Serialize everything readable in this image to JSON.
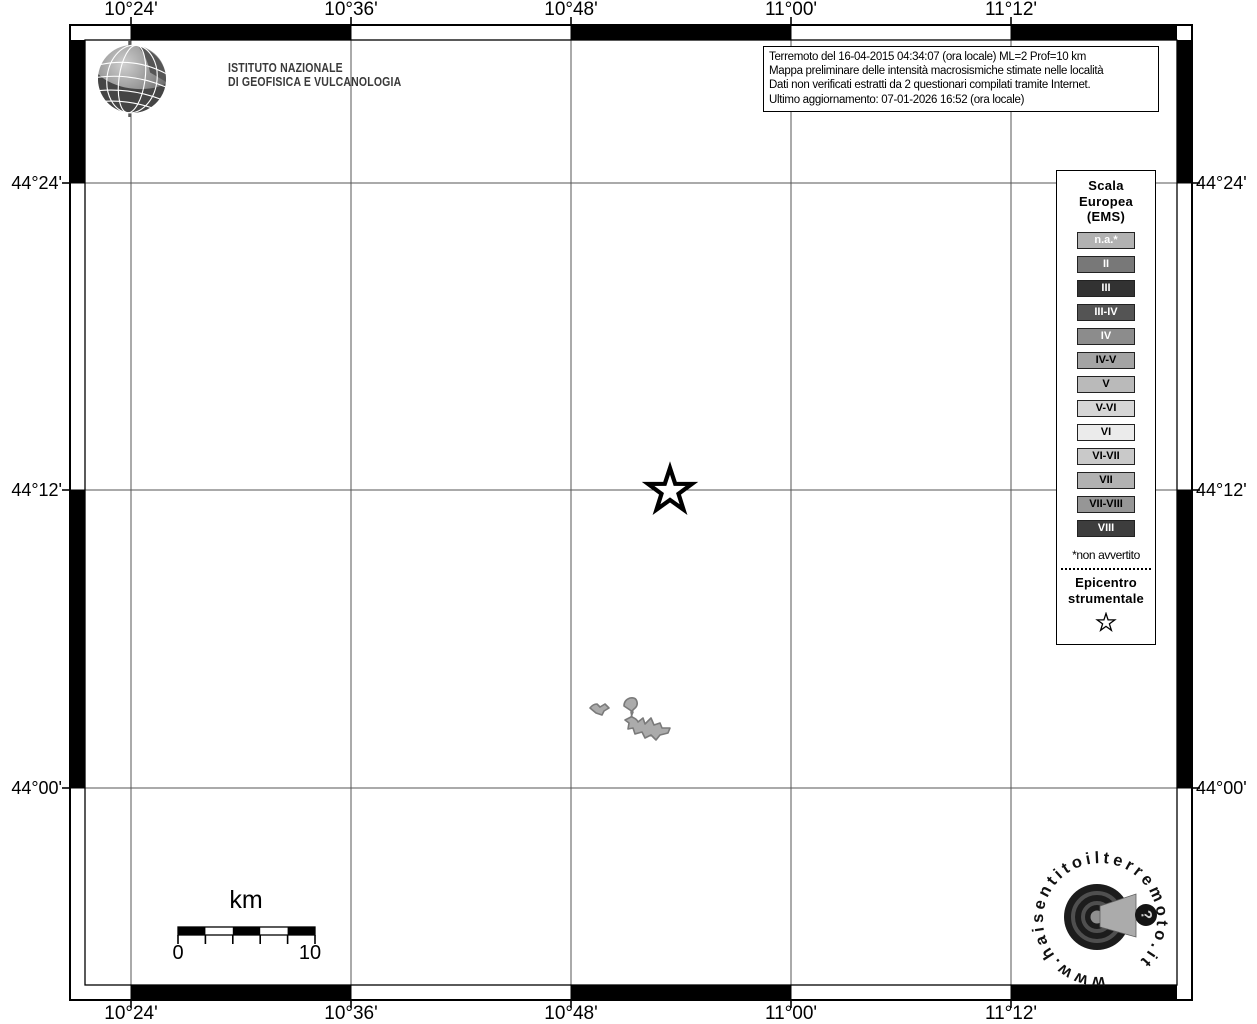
{
  "branding": {
    "institute_name": "ISTITUTO NAZIONALE\nDI GEOFISICA E VULCANOLOGIA"
  },
  "info_box": {
    "line1": "Terremoto del 16-04-2015 04:34:07 (ora locale) ML=2 Prof=10 km",
    "line2": "Mappa preliminare delle intensità macrosismiche stimate nelle località",
    "line3": "Dati non verificati estratti da 2 questionari compilati tramite Internet.",
    "line4": "Ultimo aggiornamento: 07-01-2026 16:52 (ora locale)"
  },
  "axes": {
    "top": [
      "10°24'",
      "10°36'",
      "10°48'",
      "11°00'",
      "11°12'"
    ],
    "bottom": [
      "10°24'",
      "10°36'",
      "10°48'",
      "11°00'",
      "11°12'"
    ],
    "left": [
      "44°24'",
      "44°12'",
      "44°00'"
    ],
    "right": [
      "44°24'",
      "44°12'",
      "44°00'"
    ]
  },
  "legend": {
    "title": "Scala\nEuropea\n(EMS)",
    "items": [
      {
        "label": "n.a.*",
        "bg": "#b2b2b2",
        "fg": "#ffffff"
      },
      {
        "label": "II",
        "bg": "#787878",
        "fg": "#ffffff"
      },
      {
        "label": "III",
        "bg": "#323232",
        "fg": "#ffffff"
      },
      {
        "label": "III-IV",
        "bg": "#545454",
        "fg": "#ffffff"
      },
      {
        "label": "IV",
        "bg": "#8c8c8c",
        "fg": "#ffffff"
      },
      {
        "label": "IV-V",
        "bg": "#a4a4a4",
        "fg": "#000000"
      },
      {
        "label": "V",
        "bg": "#bababa",
        "fg": "#000000"
      },
      {
        "label": "V-VI",
        "bg": "#d6d6d6",
        "fg": "#000000"
      },
      {
        "label": "VI",
        "bg": "#ebebeb",
        "fg": "#000000"
      },
      {
        "label": "VI-VII",
        "bg": "#c9c9c9",
        "fg": "#000000"
      },
      {
        "label": "VII",
        "bg": "#b2b2b2",
        "fg": "#000000"
      },
      {
        "label": "VII-VIII",
        "bg": "#969696",
        "fg": "#000000"
      },
      {
        "label": "VIII",
        "bg": "#3d3d3d",
        "fg": "#ffffff"
      }
    ],
    "footnote": "*non avvertito",
    "epicenter_title": "Epicentro\nstrumentale"
  },
  "scale_bar": {
    "unit_label": "km",
    "start_label": "0",
    "end_label": "10"
  },
  "footer_logo": {
    "ring_text": "www.haisentitoilterremoto.it",
    "question_mark": "?"
  },
  "map": {
    "background": "#ffffff",
    "grid_color": "#555555",
    "frame_color": "#000000"
  }
}
